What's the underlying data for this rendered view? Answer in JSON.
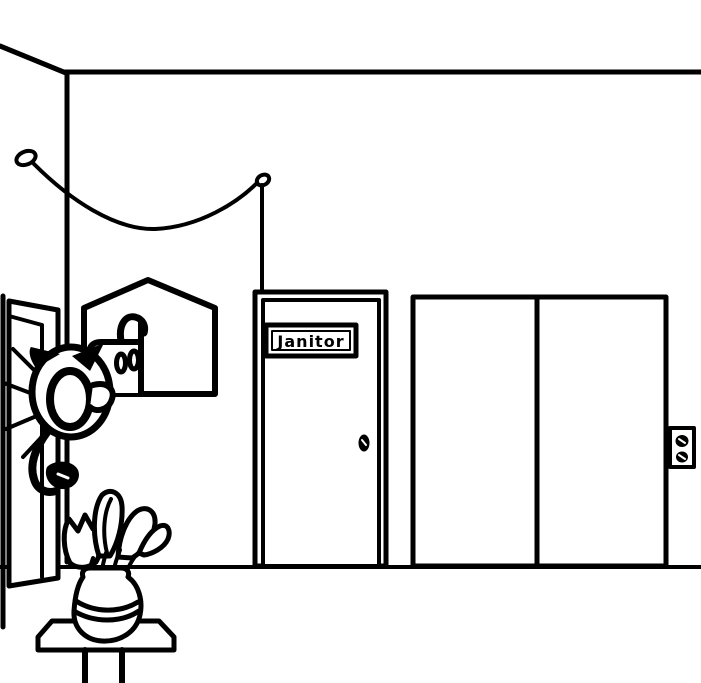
{
  "scene": {
    "description": "Hand-drawn black-and-white hallway: cat character peeking from an open door, wall fountain in house-shaped frame, Janitor door, elevator with call buttons, hanging wire, flower vase on stool",
    "colors": {
      "ink": "#000000",
      "background": "#ffffff"
    },
    "janitor_sign": {
      "label": "Janitor"
    }
  }
}
